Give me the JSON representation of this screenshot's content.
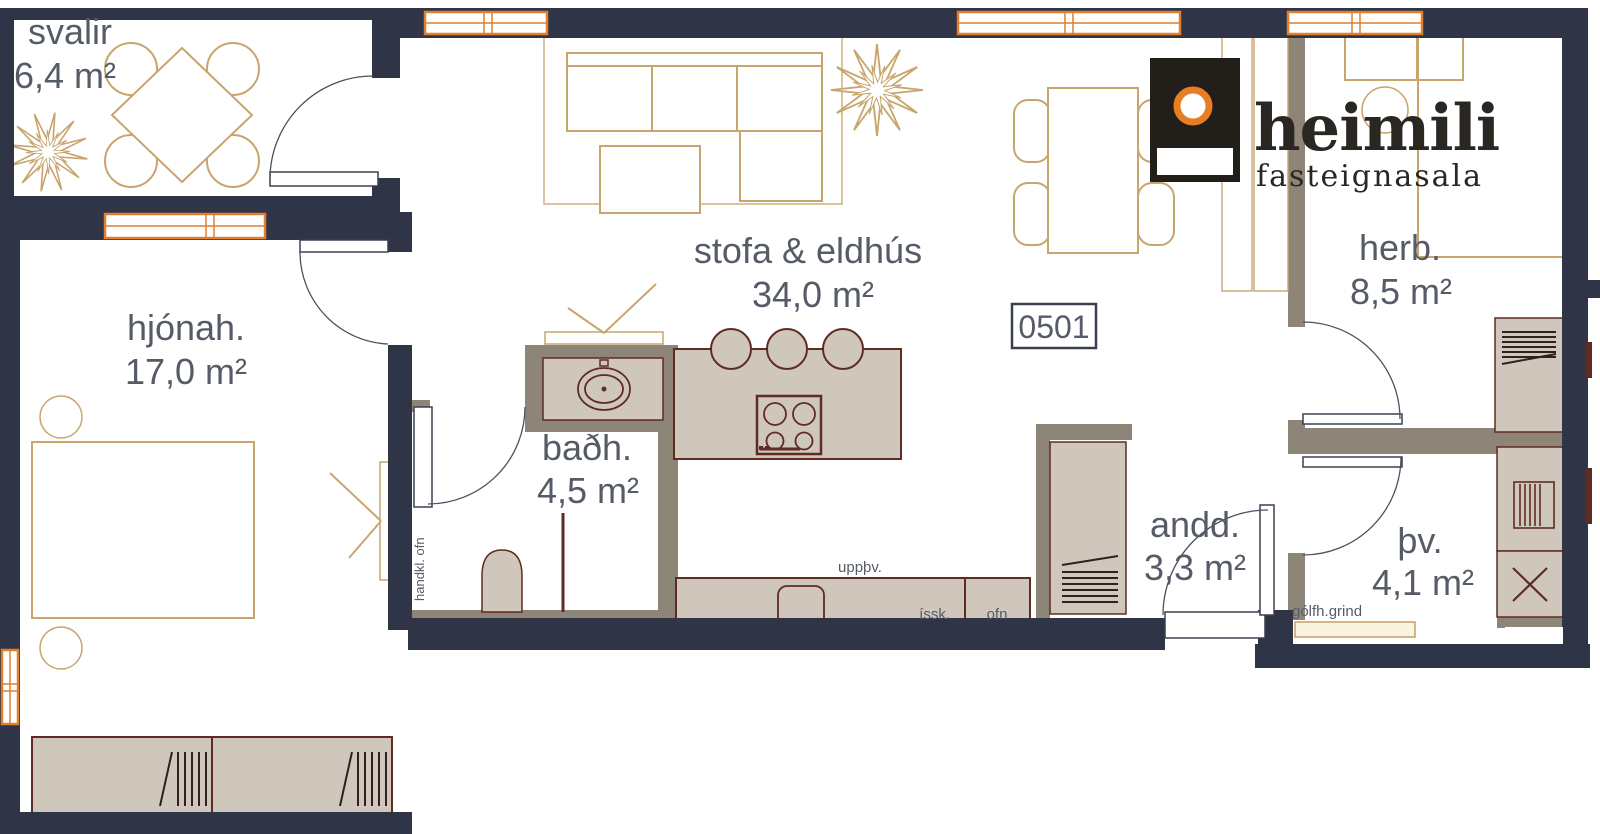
{
  "plan": {
    "unit_box": "0501",
    "rooms": {
      "svalir": {
        "name": "svalir",
        "area": "6,4 m²"
      },
      "hjonah": {
        "name": "hjónah.",
        "area": "17,0 m²"
      },
      "stofa": {
        "name": "stofa & eldhús",
        "area": "34,0 m²"
      },
      "badh": {
        "name": "baðh.",
        "area": "4,5 m²"
      },
      "andd": {
        "name": "andd.",
        "area": "3,3 m²"
      },
      "herb": {
        "name": "herb.",
        "area": "8,5 m²"
      },
      "thv": {
        "name": "þv.",
        "area": "4,1 m²"
      }
    },
    "labels": {
      "dishwasher": "uppþv.",
      "fridge": "íssk.",
      "oven": "ofn",
      "floor_heating": "gólfh.grind",
      "towel_radiator": "handkl. ofn"
    }
  },
  "logo": {
    "brand": "heimili",
    "tagline": "fasteignasala"
  },
  "colors": {
    "wall": "#2f3447",
    "partition": "#8d8577",
    "furniture_fill": "#cfc7bc",
    "furniture_stroke": "#5f2b22",
    "wood_outline": "#c9a56e",
    "label_text": "#565b68",
    "window_frame": "#e07f2e",
    "logo_orange": "#e87e23",
    "logo_black": "#221f1b"
  }
}
